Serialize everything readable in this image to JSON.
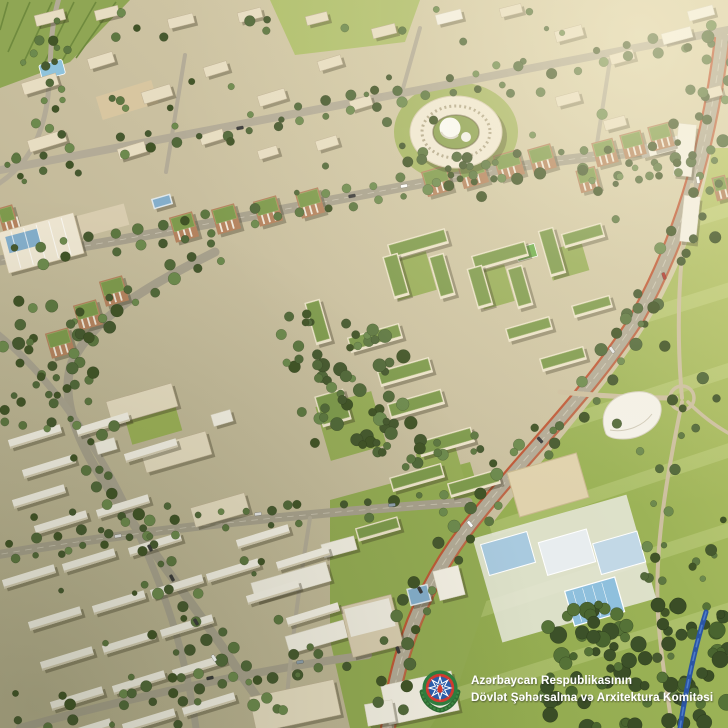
{
  "watermark": {
    "line1": "Azərbaycan Respublikasının",
    "line2": "Dövlət Şəhərsalma və Arxitektura Komitəsi",
    "emblem_icon": "azerbaijan-state-emblem"
  },
  "emblem_colors": {
    "wreath_green": "#2e6b33",
    "ring_green": "#2e7d3f",
    "ring_red": "#cf3a30",
    "field_blue": "#2a5ca8",
    "star_white": "#ffffff",
    "flame_red": "#cf3a30"
  },
  "palette": {
    "ground": "#c9bf9f",
    "ground_light": "#d8cfac",
    "road": "#a8a18d",
    "road_minor": "#b3ab97",
    "boulevard": "#b2aa96",
    "accent_lane": "#c0502e",
    "park": "#9cb357",
    "park_light": "#bac56c",
    "lawn_bright": "#a9bd62",
    "tree_dark": "#46592f",
    "tree_mid": "#5d7741",
    "tree_light": "#6d8a4e",
    "forest_dark": "#3c5129",
    "roof_green": "#7e9a4d",
    "building_cream": "#e7ddc2",
    "building_white": "#f3efe3",
    "brick": "#b5835f",
    "pool_blue": "#a9cadf",
    "glass_blue": "#84aecb",
    "water": "#2a55a4",
    "plaza_tan": "#d8c6a0",
    "text": "#ffffff"
  }
}
